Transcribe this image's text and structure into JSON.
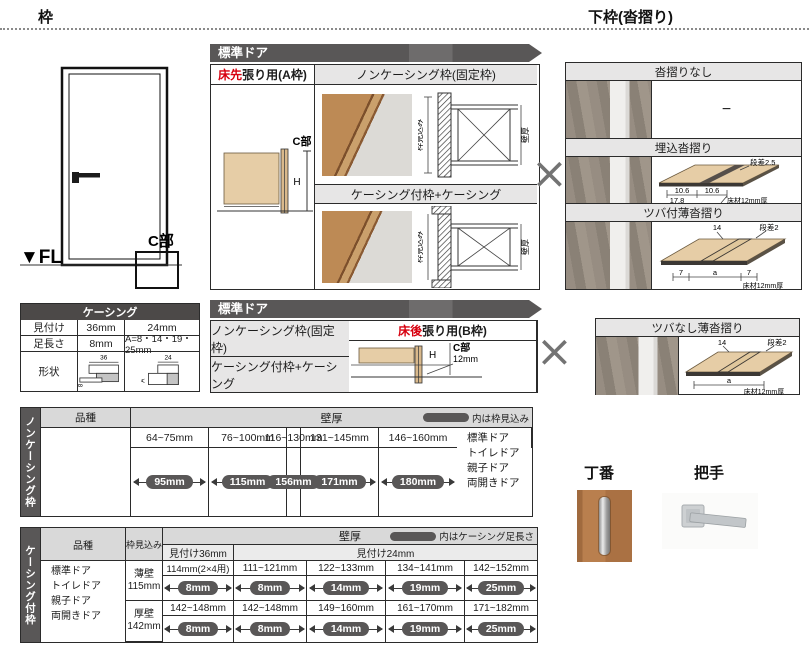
{
  "colors": {
    "header_dark": "#595757",
    "subheader_gray": "#e7e6e6",
    "table_header_gray": "#d9d9d9",
    "badge_dark": "#595757",
    "accent_red": "#d7000f",
    "diagram_tan": "#e6cda6",
    "border": "#2b2b2b"
  },
  "page": {
    "left_header": "枠",
    "right_header": "下枠(沓摺り)"
  },
  "door_elevation": {
    "fl": "▼FL",
    "c_label": "C部"
  },
  "section_a": {
    "banner": "標準ドア",
    "type_red": "床先",
    "type_rest": "張り用(A枠)",
    "c_label": "C部",
    "h_label": "H",
    "row1": "ノンケーシング枠(固定枠)",
    "row2": "ケーシング付枠+ケーシング",
    "dim_depth": "枠見込み",
    "dim_wall": "壁厚"
  },
  "section_b": {
    "banner": "標準ドア",
    "type_red": "床後",
    "type_rest": "張り用(B枠)",
    "c_label": "C部",
    "h_label": "H",
    "gap": "12mm",
    "row1": "ノンケーシング枠(固定枠)",
    "row2": "ケーシング付枠+ケーシング"
  },
  "multiply": "×",
  "shimo": {
    "s1": {
      "title": "沓摺りなし",
      "dash": "−"
    },
    "s2": {
      "title": "埋込沓摺り",
      "dansa": "段差2.5",
      "d1": "10.6",
      "d2": "10.6",
      "d3": "17.8",
      "floor": "床材12mm厚"
    },
    "s3": {
      "title": "ツバ付薄沓摺り",
      "top": "14",
      "dansa": "段差2",
      "l": "7",
      "a": "a",
      "r": "7",
      "floor": "床材12mm厚"
    },
    "s4": {
      "title": "ツバなし薄沓摺り",
      "top": "14",
      "dansa": "段差2",
      "a": "a",
      "floor": "床材12mm厚"
    }
  },
  "casing": {
    "title": "ケーシング",
    "r1_label": "見付け",
    "r1_c1": "36mm",
    "r1_c2": "24mm",
    "r2_label": "足長さ",
    "r2_c1": "8mm",
    "r2_c2": "A=8・14・19・25mm",
    "r3_label": "形状",
    "shape1_w": "36",
    "shape1_h": "8",
    "shape2_w": "24",
    "shape2_h": "A"
  },
  "table1": {
    "side": "ノンケーシング枠",
    "hinshu": "品種",
    "kabeatsu": "壁厚",
    "note": "内は枠見込み",
    "products": [
      "標準ドア",
      "トイレドア",
      "親子ドア",
      "両開きドア"
    ],
    "cols": [
      {
        "range": "64~75mm",
        "value": "95mm"
      },
      {
        "range": "76~100mm",
        "value": "115mm"
      },
      {
        "range": "116~130mm",
        "value": "156mm"
      },
      {
        "range": "131~145mm",
        "value": "171mm"
      },
      {
        "range": "146~160mm",
        "value": "180mm"
      }
    ]
  },
  "table2": {
    "side": "ケーシング付枠",
    "hinshu": "品種",
    "mikomi": "枠見込み",
    "kabeatsu": "壁厚",
    "note": "内はケーシング足長さ",
    "m36": "見付け36mm",
    "m24": "見付け24mm",
    "products": [
      "標準ドア",
      "トイレドア",
      "親子ドア",
      "両開きドア"
    ],
    "rows": [
      {
        "wall": "薄壁",
        "depth": "115mm",
        "cells": [
          {
            "range": "114mm(2×4用)",
            "value": "8mm"
          },
          {
            "range": "111~121mm",
            "value": "8mm"
          },
          {
            "range": "122~133mm",
            "value": "14mm"
          },
          {
            "range": "134~141mm",
            "value": "19mm"
          },
          {
            "range": "142~152mm",
            "value": "25mm"
          }
        ]
      },
      {
        "wall": "厚壁",
        "depth": "142mm",
        "cells": [
          {
            "range": "142~148mm",
            "value": "8mm"
          },
          {
            "range": "142~148mm",
            "value": "8mm"
          },
          {
            "range": "149~160mm",
            "value": "14mm"
          },
          {
            "range": "161~170mm",
            "value": "19mm"
          },
          {
            "range": "171~182mm",
            "value": "25mm"
          }
        ]
      }
    ]
  },
  "hardware": {
    "hinge": "丁番",
    "handle": "把手"
  }
}
